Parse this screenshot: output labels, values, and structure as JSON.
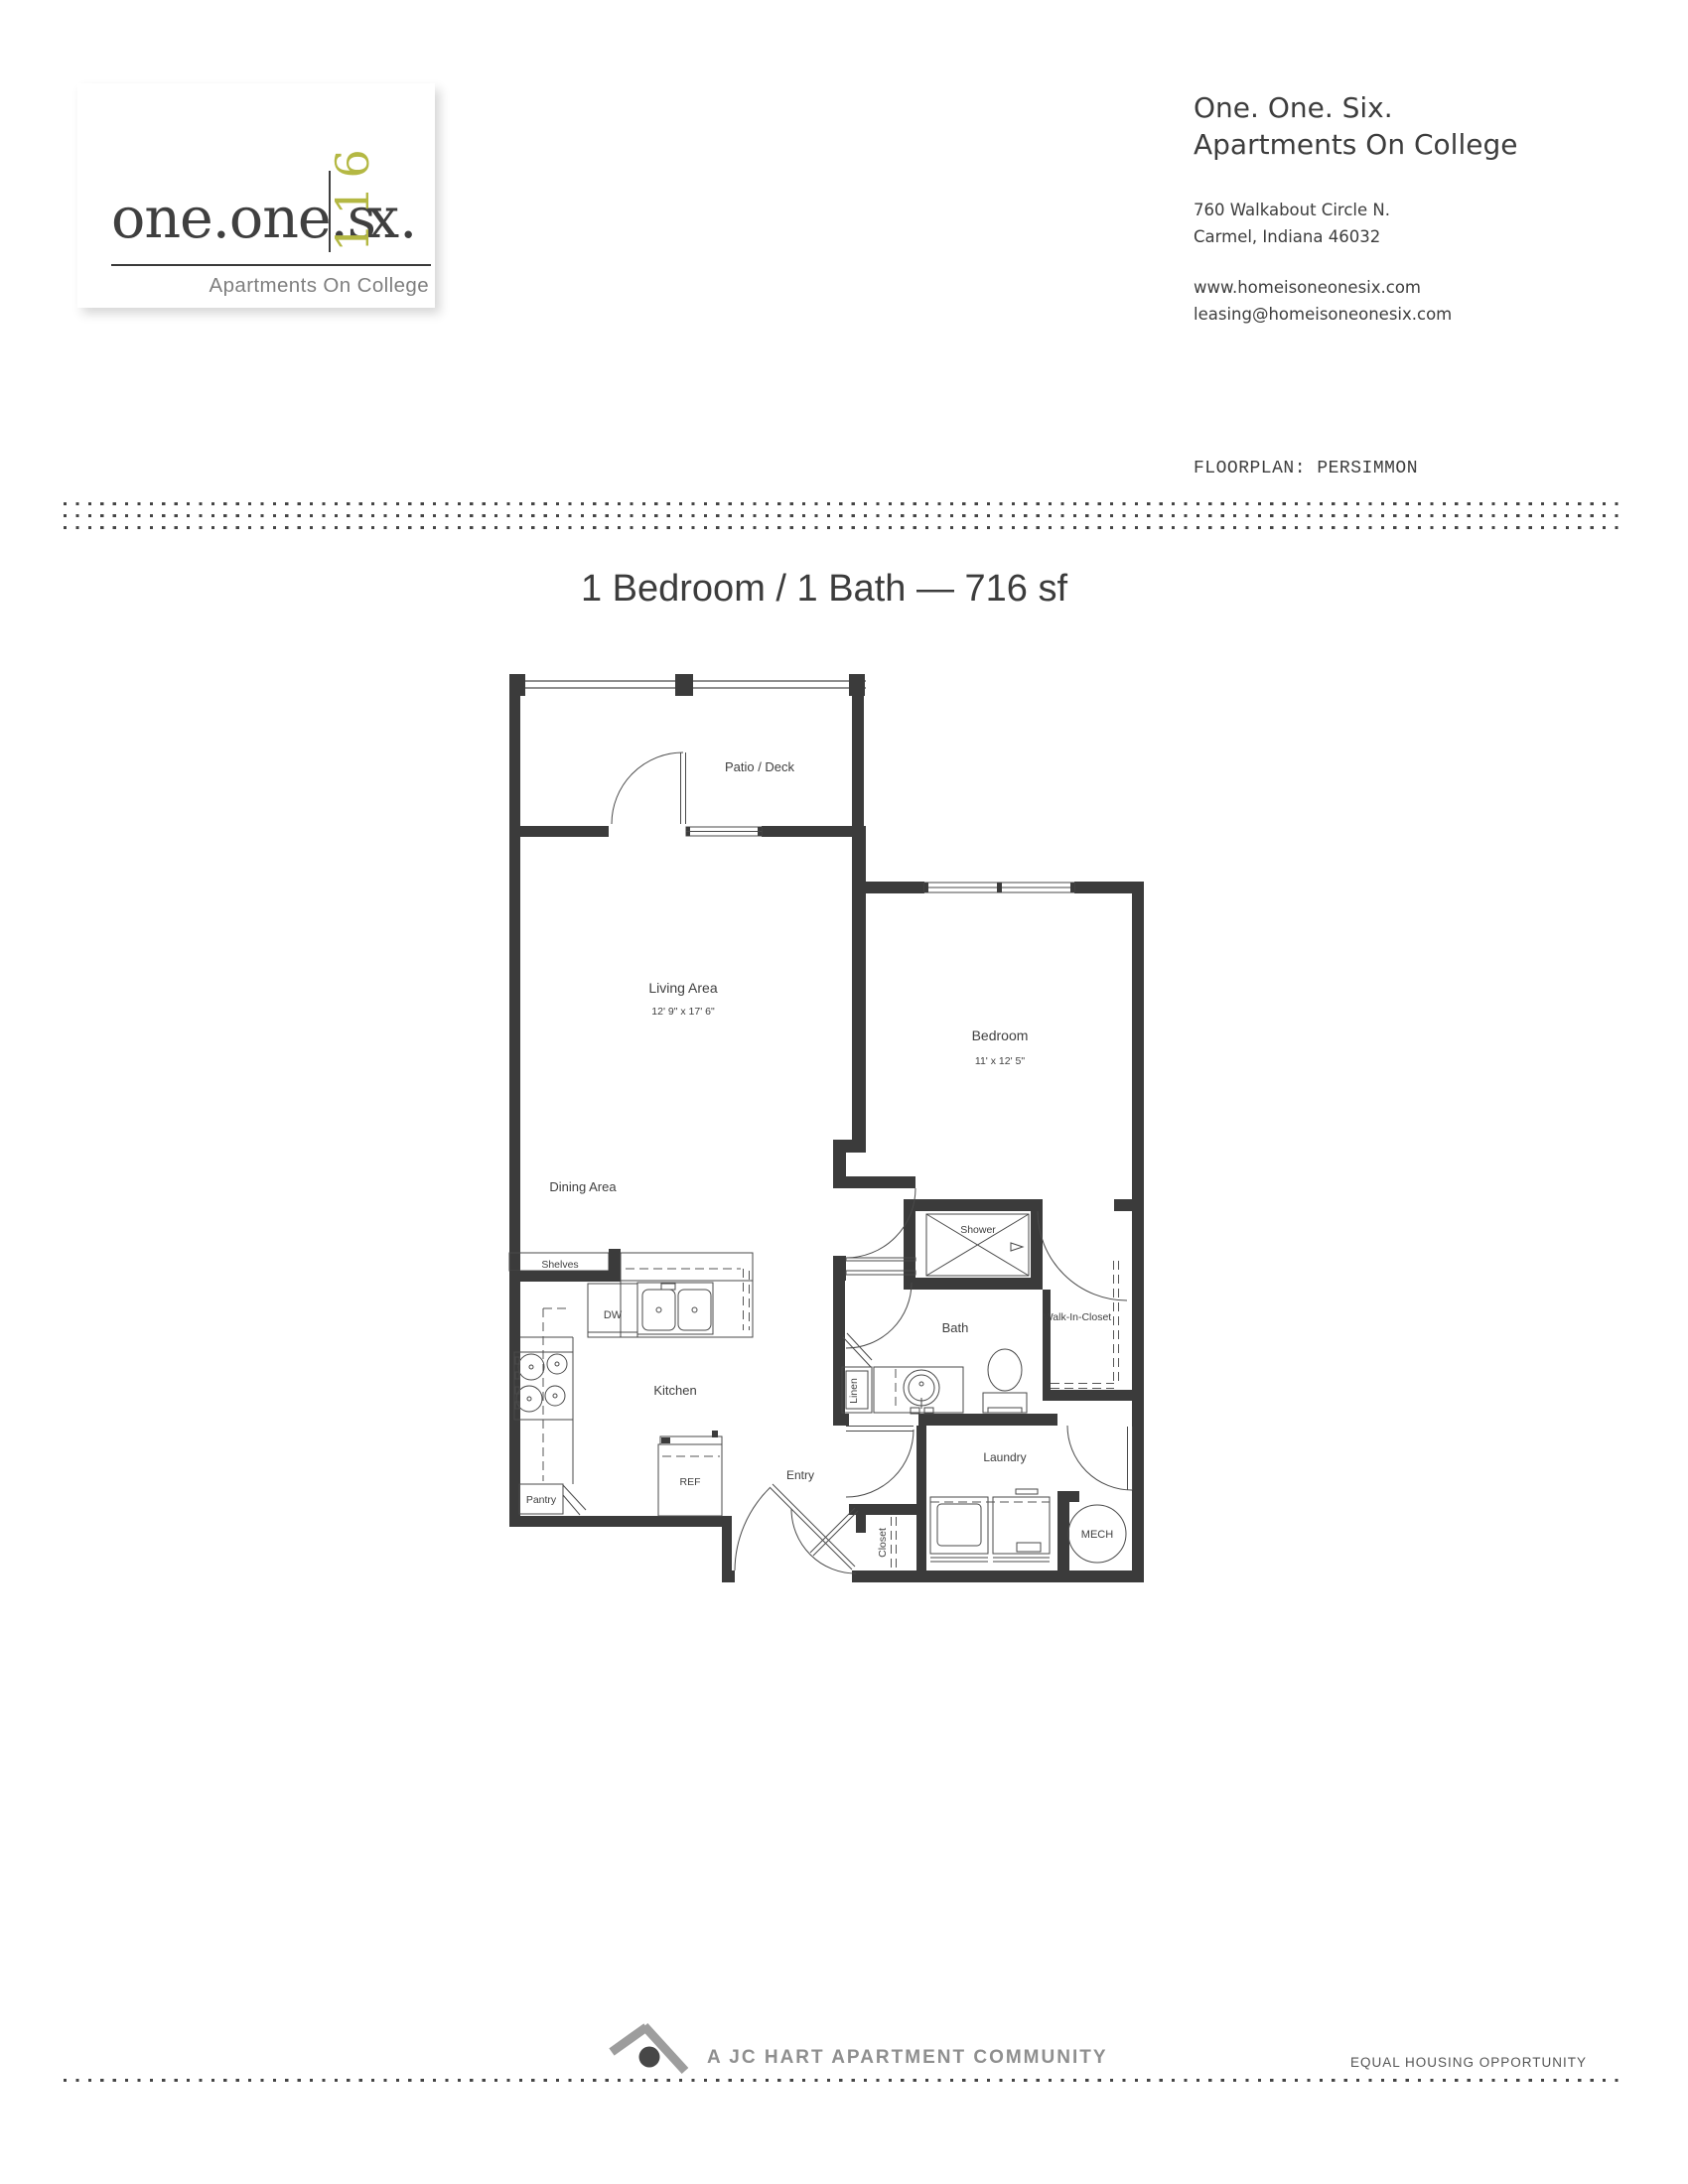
{
  "logo": {
    "wordmark_pre": "one.one.s",
    "wordmark_number": "116",
    "wordmark_post": "x.",
    "tagline": "Apartments On College",
    "accent_color": "#b4b843"
  },
  "header": {
    "title_line1": "One. One. Six.",
    "title_line2": "Apartments On College",
    "address_line1": "760 Walkabout Circle N.",
    "address_line2": "Carmel, Indiana 46032",
    "website": "www.homeisoneonesix.com",
    "email": "leasing@homeisoneonesix.com",
    "floorplan_label": "FLOORPLAN: PERSIMMON"
  },
  "plan": {
    "title": "1 Bedroom / 1 Bath — 716 sf",
    "wall_color": "#3b3b3b",
    "rooms": {
      "patio": "Patio / Deck",
      "living": "Living Area",
      "living_dim": "12' 9\" x 17' 6\"",
      "bedroom": "Bedroom",
      "bedroom_dim": "11' x 12' 5\"",
      "dining": "Dining Area",
      "shelves": "Shelves",
      "dw": "DW",
      "kitchen": "Kitchen",
      "pantry": "Pantry",
      "ref": "REF",
      "entry": "Entry",
      "closet": "Closet",
      "linen": "Linen",
      "bath": "Bath",
      "shower": "Shower",
      "walk_in_closet": "Walk-In-Closet",
      "laundry": "Laundry",
      "mech": "MECH"
    }
  },
  "footer": {
    "community": "A JC HART APARTMENT COMMUNITY",
    "eho": "EQUAL HOUSING OPPORTUNITY"
  }
}
